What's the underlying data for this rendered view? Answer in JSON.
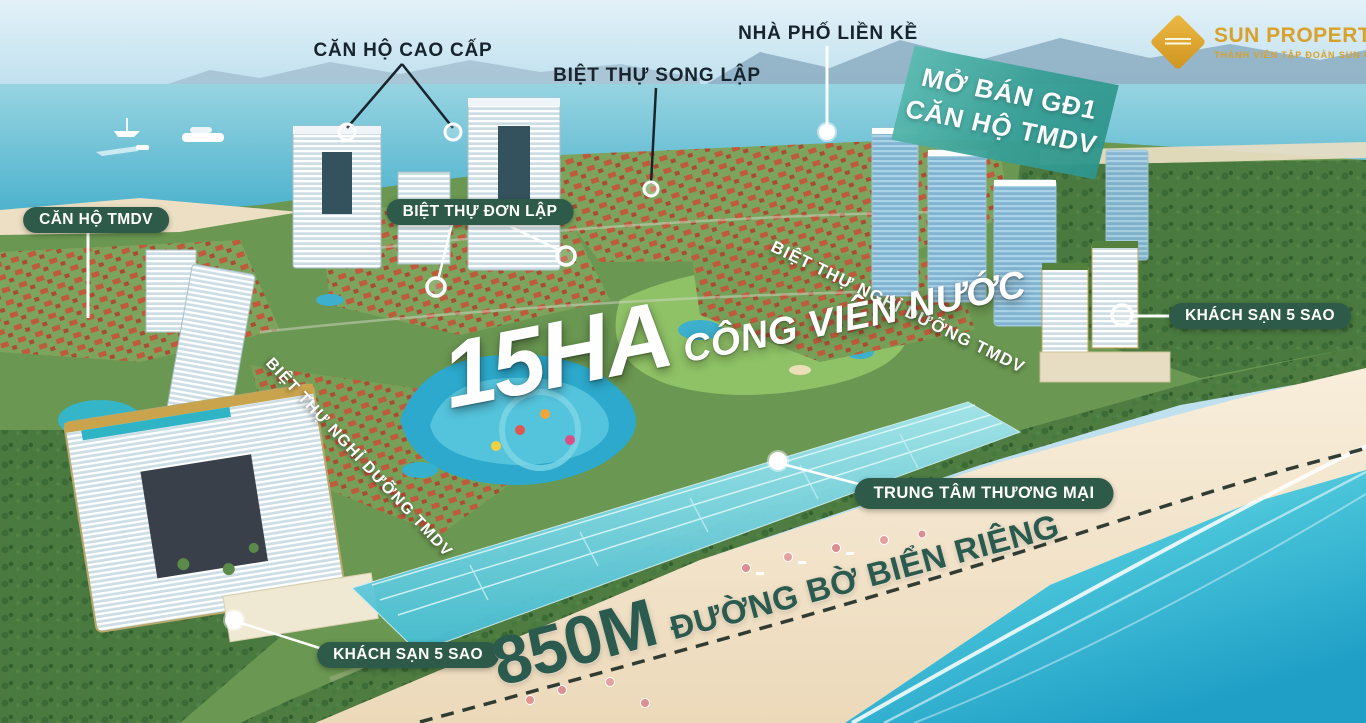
{
  "brand": {
    "name": "SUN PROPERTY",
    "registered": "®",
    "tagline": "THÀNH VIÊN TẬP ĐOÀN SUN GROUP",
    "gold": "#D8A12C"
  },
  "announcement": {
    "line1": "MỞ BÁN GĐ1",
    "line2": "CĂN HỘ TMDV",
    "background": "#3AA096"
  },
  "labels": {
    "premium_apartments": "CĂN HỘ CAO CẤP",
    "semi_detached_villas": "BIỆT THỰ SONG LẬP",
    "row_townhouses": "NHÀ PHỐ LIỀN KỀ",
    "tmdv_apartments": "CĂN HỘ TMDV",
    "detached_villas": "BIỆT THỰ ĐƠN LẬP",
    "resort_villas_left": "BIỆT THỰ NGHỈ DƯỠNG TMDV",
    "resort_villas_right": "BIỆT THỰ NGHỈ DƯỠNG TMDV",
    "five_star_hotel_right": "KHÁCH SẠN 5 SAO",
    "five_star_hotel_bottom": "KHÁCH SẠN 5 SAO",
    "shopping_mall": "TRUNG TÂM THƯƠNG MẠI"
  },
  "highlights": {
    "water_park_size": "15HA",
    "water_park_label": "CÔNG VIÊN NƯỚC",
    "beach_size": "850M",
    "beach_label": "ĐƯỜNG BỜ BIỂN RIÊNG"
  },
  "colors": {
    "pill_green": "#2E5B49",
    "beach_text_green": "#2B5A4E",
    "dark_label": "#17242D",
    "sea_teal": "#3AA9C8"
  }
}
